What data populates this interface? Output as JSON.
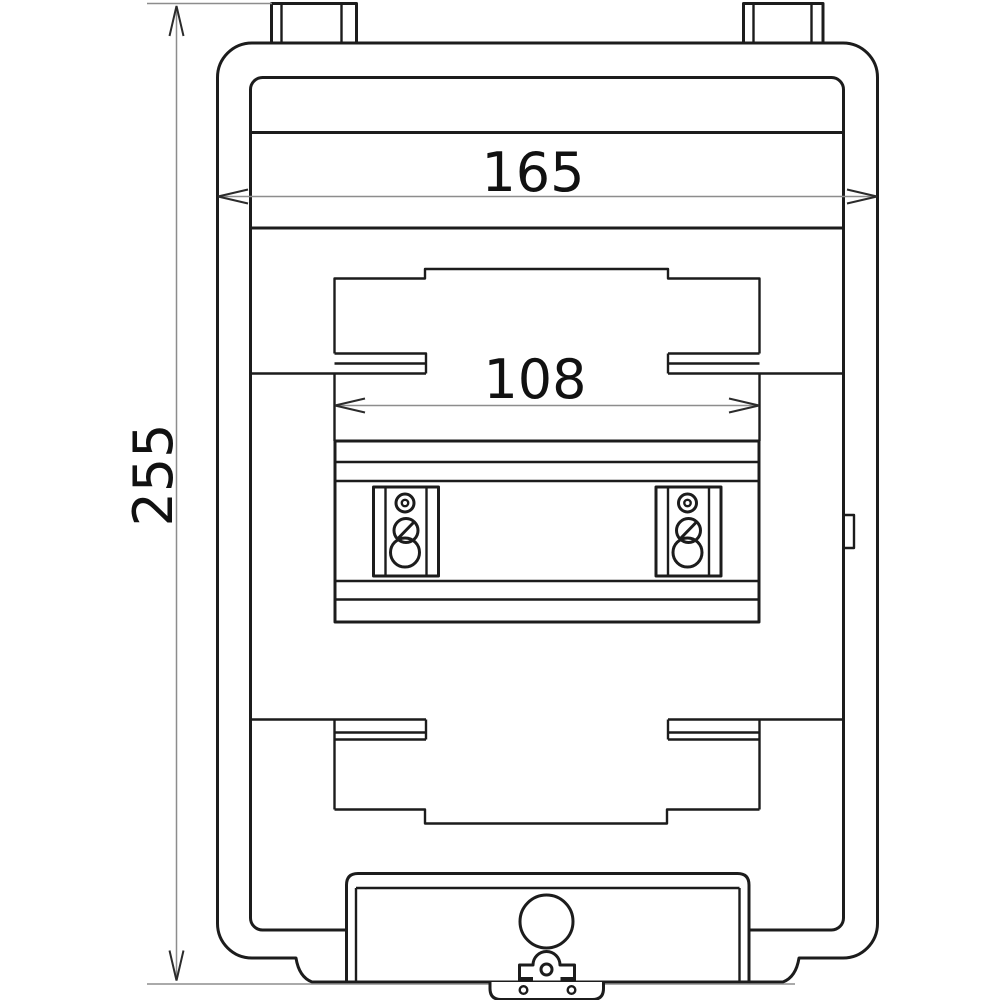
{
  "drawing": {
    "dimensions": {
      "overall_width": "165",
      "rail_width": "108",
      "overall_height": "255"
    },
    "colors": {
      "background": "#ffffff",
      "outline": "#1c1c1c",
      "dimension_line": "#8d8d8d",
      "arrow": "#2b2b2b",
      "text": "#111111"
    }
  }
}
